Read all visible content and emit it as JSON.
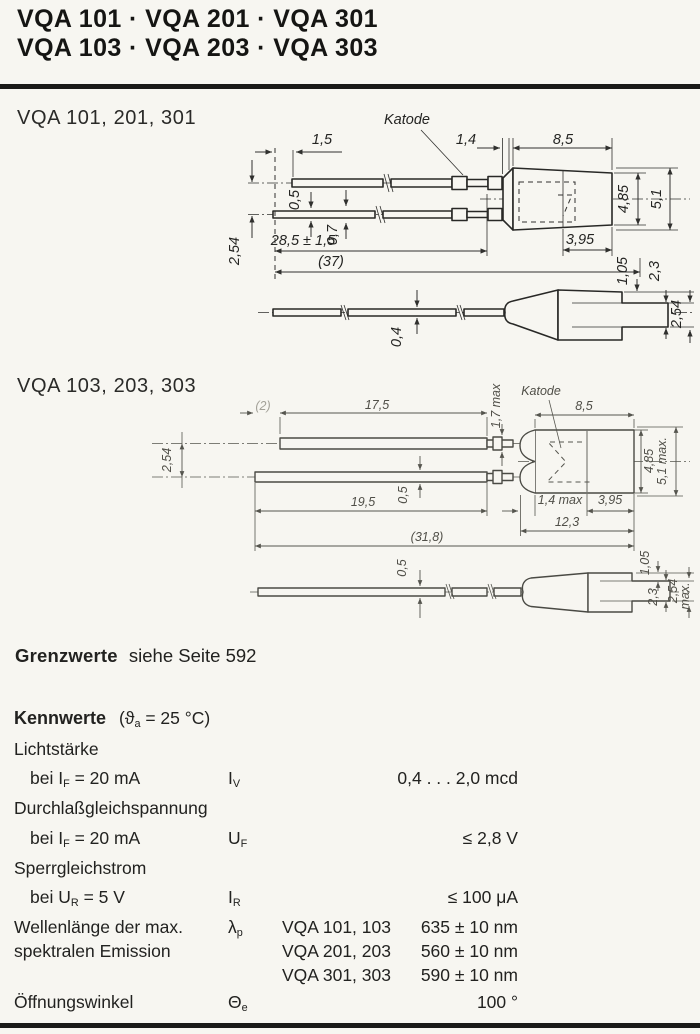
{
  "header": {
    "line1": "VQA 101 · VQA 201 · VQA 301",
    "line2": "VQA 103 · VQA 203 · VQA 303"
  },
  "drawing1": {
    "title": "VQA 101, 201, 301",
    "katode": "Katode",
    "dims": {
      "lead_stagger": "1,5",
      "seat_length": "1,4",
      "body_length": "8,5",
      "wire_thickness_a": "0,5",
      "wire_thickness_b": "0,7",
      "lead_length": "28,5 ± 1,5",
      "overall_length": "(37)",
      "lead_pitch": "2,54",
      "body_dia": "4,85",
      "flange_dia": "5,1",
      "nose_length": "3,95",
      "step_a": "1,05",
      "step_b": "2,3",
      "side_wire_thickness": "0,4",
      "side_tab_height": "2,54"
    }
  },
  "drawing2": {
    "title": "VQA 103, 203, 303",
    "katode": "Katode",
    "dims": {
      "tip_length": "(2)",
      "upper_lead_length": "17,5",
      "crimp_height": "1,7 max",
      "body_length": "8,5",
      "lead_pitch": "2,54",
      "wire_thickness": "0,5",
      "lower_lead_length": "19,5",
      "dome_length": "1,4 max",
      "nose_length": "3,95",
      "cap_length": "12,3",
      "overall_length": "(31,8)",
      "body_dia": "4,85",
      "flange_dia": "5,1 max.",
      "side_wire_thickness": "0,5",
      "side_step_a": "1,05",
      "side_step_b": "2,3",
      "side_tab_height": "2,54",
      "side_tab_height_suffix": "max."
    }
  },
  "limits": {
    "label": "Grenzwerte",
    "text": "siehe Seite 592"
  },
  "kennwerte": {
    "heading": "Kennwerte",
    "cond_pre": "(ϑ",
    "cond_sub": "a",
    "cond_post": " = 25 °C)",
    "rows": [
      {
        "param": "Lichtstärke"
      },
      {
        "cond_pre": "bei I",
        "cond_sub": "F",
        "cond_post": " = 20 mA",
        "sym": "I",
        "sym_sub": "V",
        "value": "0,4 . . . 2,0 mcd"
      },
      {
        "param": "Durchlaßgleichspannung"
      },
      {
        "cond_pre": "bei I",
        "cond_sub": "F",
        "cond_post": " = 20 mA",
        "sym": "U",
        "sym_sub": "F",
        "value": "≤ 2,8 V"
      },
      {
        "param": "Sperrgleichstrom"
      },
      {
        "cond_pre": "bei U",
        "cond_sub": "R",
        "cond_post": " = 5 V",
        "sym": "I",
        "sym_sub": "R",
        "value": "≤ 100 μA"
      },
      {
        "param": "Wellenlänge der max.",
        "sym": "λ",
        "sym_sub": "p",
        "type": "VQA 101, 103",
        "value": "635 ± 10 nm"
      },
      {
        "param": "spektralen Emission",
        "type": "VQA 201, 203",
        "value": "560 ± 10 nm"
      },
      {
        "type": "VQA 301, 303",
        "value": "590 ± 10 nm"
      },
      {
        "param": "Öffnungswinkel",
        "sym": "Θ",
        "sym_sub": "e",
        "value": "100 °"
      }
    ]
  }
}
